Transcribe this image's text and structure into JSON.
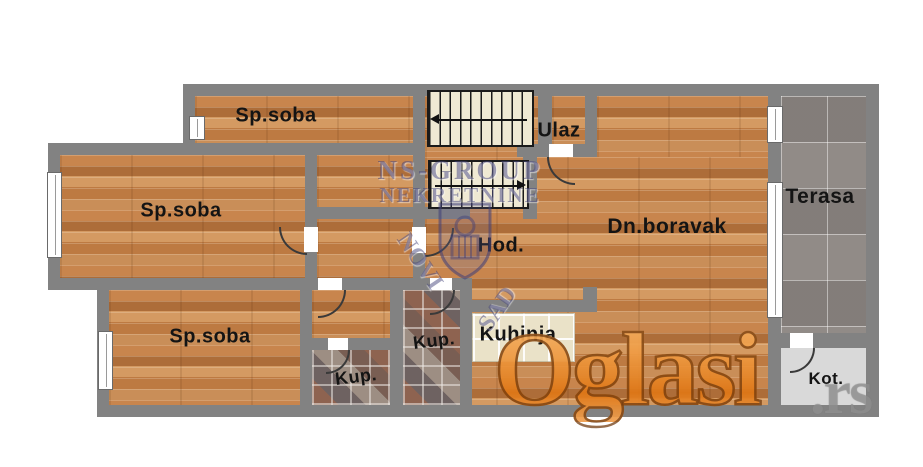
{
  "plan": {
    "rooms": [
      {
        "key": "bedroom-top",
        "label": "Sp.soba"
      },
      {
        "key": "bedroom-middle",
        "label": "Sp.soba"
      },
      {
        "key": "bedroom-bottom",
        "label": "Sp.soba"
      },
      {
        "key": "entrance",
        "label": "Ulaz"
      },
      {
        "key": "living-room",
        "label": "Dn.boravak"
      },
      {
        "key": "hallway",
        "label": "Hod."
      },
      {
        "key": "kitchen",
        "label": "Kuhinja"
      },
      {
        "key": "bathroom-large",
        "label": "Kup."
      },
      {
        "key": "bathroom-small",
        "label": "Kup."
      },
      {
        "key": "terrace",
        "label": "Terasa"
      },
      {
        "key": "boiler-room",
        "label": "Kot."
      }
    ]
  },
  "watermarks": {
    "agency": {
      "line1": "NS-GROUP",
      "line2": "NEKRETNINE",
      "city_left": "NOVI",
      "city_right": "SAD"
    },
    "portal": {
      "name": "Oglasi",
      "tld": ".rs"
    }
  },
  "colors": {
    "wall": "#828282",
    "wood_floor": "#c2824e",
    "terrace_tile": "#8b8581",
    "boiler_floor": "#d9d9d9",
    "portal_orange": "#e8872f",
    "agency_blue": "#3e3e78"
  }
}
